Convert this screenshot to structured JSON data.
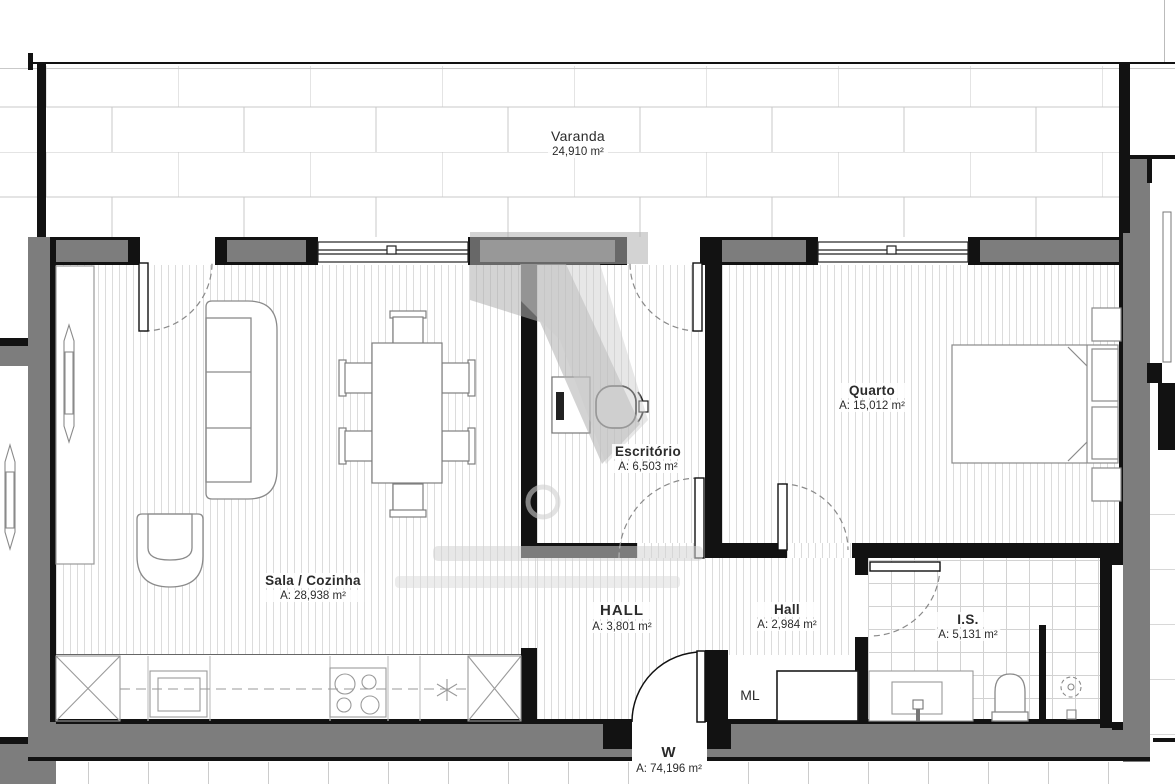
{
  "plan": {
    "rooms": [
      {
        "id": "varanda",
        "name": "Varanda",
        "area": "24,910 m²"
      },
      {
        "id": "sala-cozinha",
        "name": "Sala / Cozinha",
        "area": "A: 28,938 m²"
      },
      {
        "id": "escritorio",
        "name": "Escritório",
        "area": "A: 6,503 m²"
      },
      {
        "id": "quarto",
        "name": "Quarto",
        "area": "A: 15,012 m²"
      },
      {
        "id": "hall-main",
        "name": "HALL",
        "area": "A: 3,801 m²"
      },
      {
        "id": "hall-small",
        "name": "Hall",
        "area": "A: 2,984 m²"
      },
      {
        "id": "is",
        "name": "I.S.",
        "area": "A: 5,131 m²"
      },
      {
        "id": "w",
        "name": "W",
        "area": "A: 74,196 m²"
      }
    ],
    "labels": {
      "ml": "ML"
    },
    "icons": [
      "sofa",
      "armchair",
      "dining-table",
      "dining-chair",
      "tv",
      "sideboard",
      "desk",
      "office-chair",
      "double-bed",
      "nightstand",
      "kitchen-sink",
      "cooktop",
      "extractor-asterisk",
      "corner-cabinet-x",
      "washing-machine",
      "vanity-sink",
      "toilet",
      "shower-drain",
      "door-swing",
      "window"
    ],
    "colors": {
      "wall_gray": "#7d7d7d",
      "wall_dark": "#121212",
      "floor_hatch_line": "#dcdcdc",
      "tile_line": "#d2d2d2",
      "text": "#2b2b2b",
      "watermark": "#b3b3b3"
    }
  }
}
